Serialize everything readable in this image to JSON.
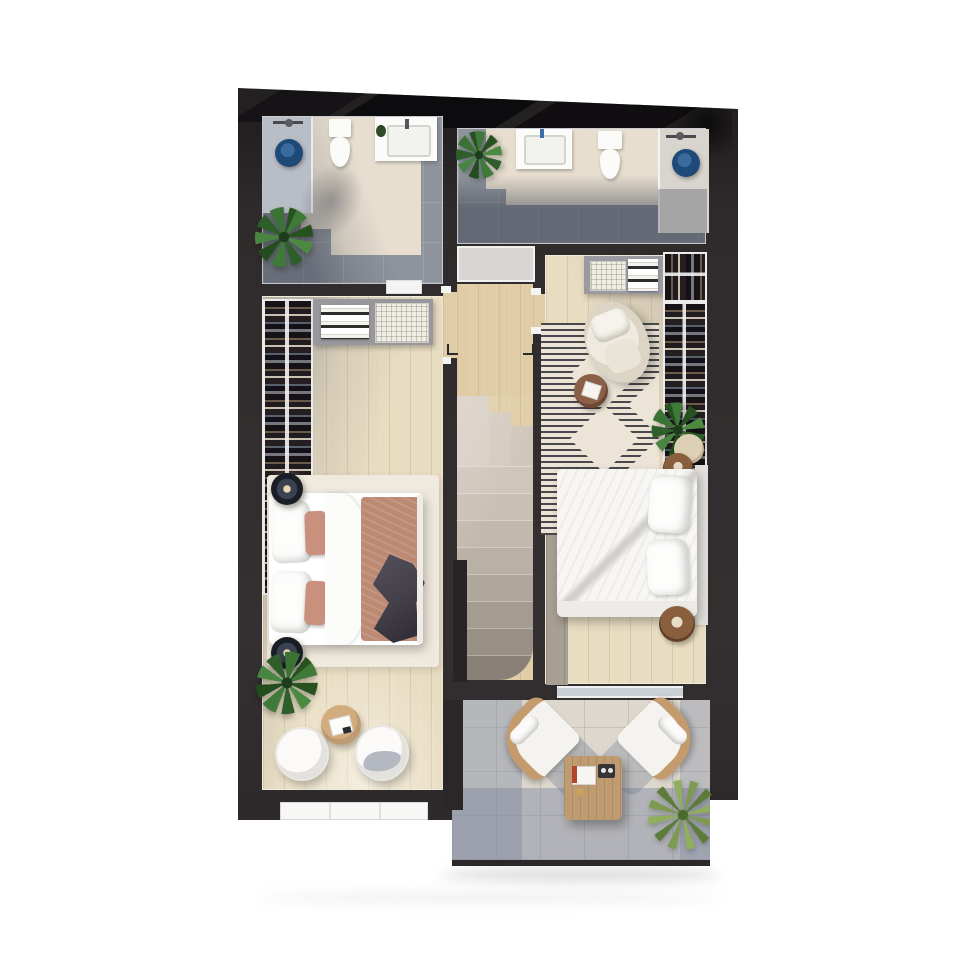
{
  "scene": {
    "label": "Upper floor 3D floor plan, top-down view",
    "type": "architectural-render",
    "view": "top-down"
  },
  "colors": {
    "wall": "#2f2b2c",
    "wall-deep": "#181517",
    "wood-light": "#e8dcc1",
    "wood-hall": "#e0cda6",
    "wood-gray": "#a89f93",
    "tile-beige": "#e7decf",
    "tile-gray": "#8e939c",
    "shower-zone": "#b9bdc5",
    "alcove": "#d8d4ce",
    "terrace-tile": "#ddd7cd",
    "terrace-shadow": "#7e88a0",
    "rug-cream": "#f0e9dd",
    "rug2-base": "#ebe4d6",
    "rug2-stripe": "#2e2d33",
    "rug2-diamond": "#ece5d7",
    "blanket": "#bc8973",
    "pillow-accent": "#c9907e",
    "throw": "#45414a",
    "closet": "#75777c",
    "navy": "#1d4a78",
    "rattan": "#c49b6d",
    "table-wood": "#bf9b72",
    "brown": "#8a5f3e",
    "plant": "#3f7a3a",
    "plant-dark": "#27521f",
    "grass": "#7c9a52",
    "white-furn": "#f5f4f1",
    "headboard": "#e2e0db",
    "glass": "#cbd0d6"
  },
  "rooms": {
    "bathroom_left": {
      "label": "Left bathroom",
      "items": [
        "shower",
        "shower-stool",
        "toilet",
        "vanity-sink",
        "plant"
      ]
    },
    "bathroom_right": {
      "label": "Right bathroom",
      "items": [
        "plant",
        "vanity-sink",
        "toilet",
        "shower",
        "shower-stool",
        "shower-alcove"
      ]
    },
    "hall": {
      "label": "Landing hall",
      "items": [
        "shower-tray",
        "doorways"
      ]
    },
    "staircase": {
      "label": "Staircase",
      "items": [
        "landing",
        "winder-steps",
        "straight-steps"
      ]
    },
    "bedroom_left": {
      "label": "Left bedroom",
      "items": [
        "open-wardrobe",
        "dresser",
        "laundry-basket",
        "double-bed",
        "terracotta-blanket",
        "throw-blanket",
        "nightstand-lamp",
        "nightstand-lamp",
        "area-rug",
        "plant",
        "round-table",
        "lounge-chair",
        "lounge-chair",
        "window-sill"
      ]
    },
    "bedroom_right": {
      "label": "Right bedroom",
      "items": [
        "wardrobe-shelf",
        "open-wardrobe",
        "patterned-rug",
        "lounge-chair",
        "side-table",
        "plant",
        "pouf",
        "round-nightstand",
        "double-bed",
        "headboard",
        "round-nightstand",
        "terrace-door"
      ]
    },
    "terrace": {
      "label": "Terrace",
      "items": [
        "rattan-chair",
        "rattan-chair",
        "coffee-table",
        "books",
        "tray",
        "grass-plant"
      ]
    }
  }
}
